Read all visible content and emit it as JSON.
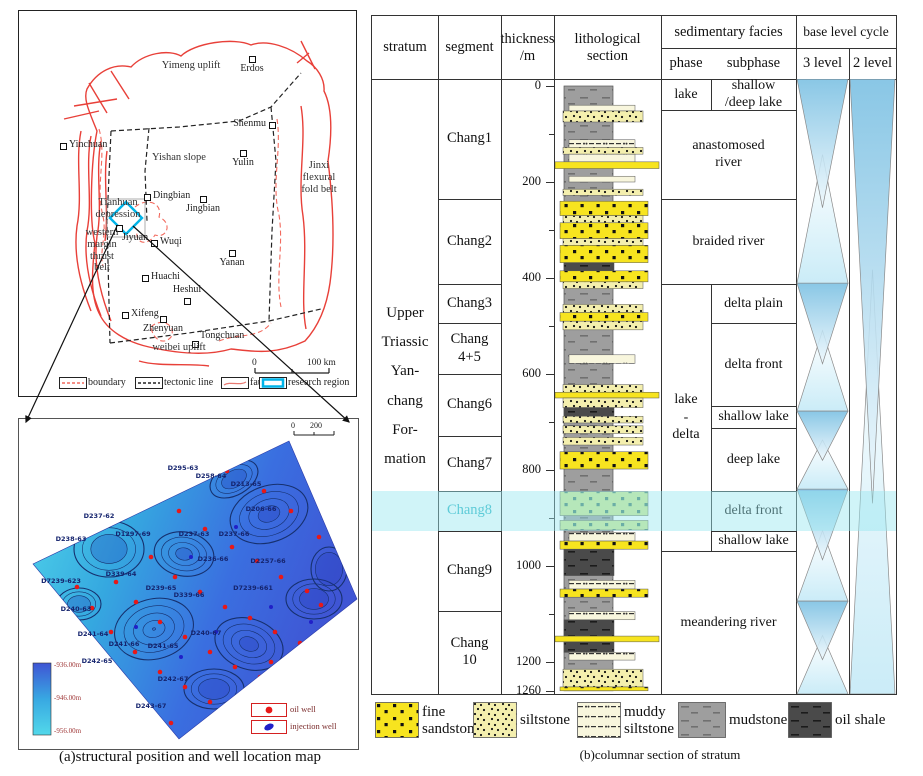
{
  "colors": {
    "map_red": "#e84039",
    "research_cyan": "#00b4e8",
    "oil_well_red": "#e81818",
    "injection_blue": "#2020c8",
    "highlight_band": "rgba(150,230,240,0.45)",
    "chang8_text": "#2fb4c4",
    "contour_navy": "#16306e"
  },
  "captions": {
    "a": "(a)structural position and well location map",
    "b": "(b)columnar section of stratum"
  },
  "map": {
    "cities": [
      {
        "name": "Yinchuan",
        "x": 44,
        "y": 135,
        "a": "r"
      },
      {
        "name": "Erdos",
        "x": 233,
        "y": 48,
        "a": "b"
      },
      {
        "name": "Shenmu",
        "x": 253,
        "y": 114,
        "a": "l"
      },
      {
        "name": "Yulin",
        "x": 224,
        "y": 142,
        "a": "b"
      },
      {
        "name": "Dingbian",
        "x": 128,
        "y": 186,
        "a": "r"
      },
      {
        "name": "Jingbian",
        "x": 184,
        "y": 188,
        "a": "b"
      },
      {
        "name": "Jiyuan",
        "x": 100,
        "y": 217,
        "a": "br"
      },
      {
        "name": "Wuqi",
        "x": 135,
        "y": 232,
        "a": "r"
      },
      {
        "name": "Yanan",
        "x": 213,
        "y": 242,
        "a": "b"
      },
      {
        "name": "Huachi",
        "x": 126,
        "y": 267,
        "a": "r"
      },
      {
        "name": "Heshui",
        "x": 168,
        "y": 290,
        "a": "t"
      },
      {
        "name": "Xifeng",
        "x": 106,
        "y": 304,
        "a": "r"
      },
      {
        "name": "Zhenyuan",
        "x": 144,
        "y": 308,
        "a": "b"
      },
      {
        "name": "Tongchuan",
        "x": 176,
        "y": 333,
        "a": "tr"
      }
    ],
    "regions": [
      {
        "lines": [
          "Yimeng uplift"
        ],
        "x": 172,
        "y": 55
      },
      {
        "lines": [
          "Yishan slope"
        ],
        "x": 160,
        "y": 147
      },
      {
        "lines": [
          "Jinxi",
          "flexural",
          "fold belt"
        ],
        "x": 300,
        "y": 155
      },
      {
        "lines": [
          "Tianhuan",
          "depression"
        ],
        "x": 99,
        "y": 192
      },
      {
        "lines": [
          "western",
          "margin",
          "thrust",
          "belt"
        ],
        "x": 83,
        "y": 222
      },
      {
        "lines": [
          "weibei uplift"
        ],
        "x": 160,
        "y": 337
      }
    ],
    "legend": [
      {
        "label": "boundary",
        "type": "rdash",
        "x": 40
      },
      {
        "label": "tectonic line",
        "type": "kdash",
        "x": 116
      },
      {
        "label": "fault",
        "type": "rline",
        "x": 202
      },
      {
        "label": "research region",
        "type": "crect",
        "x": 240
      }
    ],
    "scale": {
      "left": "0",
      "right": "100 km"
    }
  },
  "contour": {
    "scale": {
      "left": "0",
      "right": "200"
    },
    "colorbar_labels": [
      "-936.00m",
      "-946.00m",
      "-956.00m"
    ],
    "legend": [
      {
        "label": "oil well",
        "dot": "#e81818"
      },
      {
        "label": "injection well",
        "dot": "#2020c8"
      }
    ],
    "well_labels": [
      {
        "name": "D295-63",
        "x": 164,
        "y": 49
      },
      {
        "name": "D258-64",
        "x": 192,
        "y": 57
      },
      {
        "name": "D213-65",
        "x": 227,
        "y": 65
      },
      {
        "name": "D206-66",
        "x": 242,
        "y": 90
      },
      {
        "name": "D237-62",
        "x": 80,
        "y": 97
      },
      {
        "name": "D1297-69",
        "x": 114,
        "y": 115
      },
      {
        "name": "D237-63",
        "x": 175,
        "y": 115
      },
      {
        "name": "D237-66",
        "x": 215,
        "y": 115
      },
      {
        "name": "D238-63",
        "x": 52,
        "y": 120
      },
      {
        "name": "D236-66",
        "x": 194,
        "y": 140
      },
      {
        "name": "D2257-66",
        "x": 249,
        "y": 142
      },
      {
        "name": "D339-64",
        "x": 102,
        "y": 155
      },
      {
        "name": "D7239-623",
        "x": 42,
        "y": 162
      },
      {
        "name": "D239-65",
        "x": 142,
        "y": 169
      },
      {
        "name": "D339-66",
        "x": 170,
        "y": 176
      },
      {
        "name": "D7239-661",
        "x": 234,
        "y": 169
      },
      {
        "name": "D240-63",
        "x": 57,
        "y": 190
      },
      {
        "name": "D241-64",
        "x": 74,
        "y": 215
      },
      {
        "name": "D240-67",
        "x": 187,
        "y": 214
      },
      {
        "name": "D241-66",
        "x": 105,
        "y": 225
      },
      {
        "name": "D241-65",
        "x": 144,
        "y": 227
      },
      {
        "name": "D242-65",
        "x": 78,
        "y": 242
      },
      {
        "name": "D242-67",
        "x": 154,
        "y": 260
      },
      {
        "name": "D243-67",
        "x": 132,
        "y": 287
      }
    ],
    "oil_wells": [
      [
        208,
        52
      ],
      [
        245,
        72
      ],
      [
        272,
        92
      ],
      [
        300,
        118
      ],
      [
        160,
        92
      ],
      [
        186,
        110
      ],
      [
        213,
        128
      ],
      [
        238,
        142
      ],
      [
        262,
        158
      ],
      [
        288,
        172
      ],
      [
        132,
        138
      ],
      [
        156,
        158
      ],
      [
        181,
        173
      ],
      [
        206,
        188
      ],
      [
        231,
        199
      ],
      [
        256,
        213
      ],
      [
        281,
        224
      ],
      [
        97,
        163
      ],
      [
        117,
        183
      ],
      [
        141,
        203
      ],
      [
        166,
        218
      ],
      [
        191,
        233
      ],
      [
        216,
        248
      ],
      [
        241,
        258
      ],
      [
        73,
        189
      ],
      [
        92,
        213
      ],
      [
        116,
        233
      ],
      [
        141,
        253
      ],
      [
        166,
        268
      ],
      [
        191,
        283
      ],
      [
        216,
        293
      ],
      [
        58,
        168
      ],
      [
        252,
        243
      ],
      [
        302,
        186
      ],
      [
        310,
        206
      ],
      [
        80,
        247
      ],
      [
        103,
        260
      ],
      [
        128,
        292
      ],
      [
        152,
        304
      ],
      [
        176,
        316
      ]
    ],
    "injection_wells": [
      [
        217,
        108
      ],
      [
        172,
        138
      ],
      [
        117,
        208
      ],
      [
        197,
        213
      ],
      [
        252,
        188
      ],
      [
        162,
        238
      ],
      [
        227,
        273
      ],
      [
        292,
        203
      ]
    ]
  },
  "table": {
    "headers": {
      "stratum": "stratum",
      "segment": "segment",
      "thickness": [
        "thickness",
        "/m"
      ],
      "lithology": [
        "lithological",
        "section"
      ],
      "facies": "sedimentary facies",
      "phase": "phase",
      "subphase": "subphase",
      "cycle": "base level cycle",
      "l3": "3 level",
      "l2": "2 level"
    },
    "stratum_lines": [
      "Upper",
      "Triassic",
      "Yan-",
      "chang",
      "For-",
      "mation"
    ],
    "segments": [
      {
        "lines": [
          "Chang1"
        ],
        "f0": 0.0,
        "f1": 0.195
      },
      {
        "lines": [
          "Chang2"
        ],
        "f0": 0.195,
        "f1": 0.333
      },
      {
        "lines": [
          "Chang3"
        ],
        "f0": 0.333,
        "f1": 0.397
      },
      {
        "lines": [
          "Chang",
          "4+5"
        ],
        "f0": 0.397,
        "f1": 0.48
      },
      {
        "lines": [
          "Chang6"
        ],
        "f0": 0.48,
        "f1": 0.58
      },
      {
        "lines": [
          "Chang7"
        ],
        "f0": 0.58,
        "f1": 0.67
      },
      {
        "lines": [
          "Chang8"
        ],
        "f0": 0.67,
        "f1": 0.735,
        "highlight": true
      },
      {
        "lines": [
          "Chang9"
        ],
        "f0": 0.735,
        "f1": 0.865
      },
      {
        "lines": [
          "Chang",
          "10"
        ],
        "f0": 0.865,
        "f1": 1.0
      }
    ],
    "depth": {
      "max_m": 1260,
      "major_ticks": [
        {
          "m": 0,
          "label": "0"
        },
        {
          "m": 200,
          "label": "200"
        },
        {
          "m": 400,
          "label": "400"
        },
        {
          "m": 600,
          "label": "600"
        },
        {
          "m": 800,
          "label": "800"
        },
        {
          "m": 1000,
          "label": "1000"
        },
        {
          "m": 1200,
          "label": "1200"
        },
        {
          "m": 1260,
          "label": "1260"
        }
      ],
      "minor_ticks": [
        100,
        300,
        500,
        700,
        900,
        1100
      ]
    },
    "lithology_layers": [
      [
        40,
        52,
        "ms"
      ],
      [
        52,
        75,
        "st"
      ],
      [
        112,
        128,
        "ms"
      ],
      [
        128,
        142,
        "st"
      ],
      [
        142,
        158,
        "ms"
      ],
      [
        158,
        172,
        "ss"
      ],
      [
        188,
        200,
        "ms"
      ],
      [
        215,
        228,
        "st"
      ],
      [
        240,
        270,
        "fs"
      ],
      [
        270,
        285,
        "st"
      ],
      [
        285,
        318,
        "fs"
      ],
      [
        318,
        332,
        "st"
      ],
      [
        332,
        368,
        "fs"
      ],
      [
        368,
        385,
        "os"
      ],
      [
        385,
        408,
        "fs"
      ],
      [
        408,
        422,
        "st"
      ],
      [
        455,
        472,
        "st"
      ],
      [
        472,
        490,
        "fs"
      ],
      [
        490,
        508,
        "st"
      ],
      [
        560,
        578,
        "ms"
      ],
      [
        622,
        638,
        "st"
      ],
      [
        638,
        650,
        "ss"
      ],
      [
        650,
        670,
        "st"
      ],
      [
        670,
        688,
        "os"
      ],
      [
        688,
        702,
        "st"
      ],
      [
        708,
        724,
        "st"
      ],
      [
        732,
        748,
        "st"
      ],
      [
        762,
        798,
        "fs"
      ],
      [
        845,
        895,
        "g8"
      ],
      [
        905,
        925,
        "g8"
      ],
      [
        930,
        948,
        "ms"
      ],
      [
        948,
        965,
        "fs"
      ],
      [
        965,
        1020,
        "os"
      ],
      [
        1030,
        1048,
        "ms"
      ],
      [
        1048,
        1065,
        "fs"
      ],
      [
        1095,
        1112,
        "ms"
      ],
      [
        1112,
        1146,
        "os"
      ],
      [
        1146,
        1158,
        "ss"
      ],
      [
        1158,
        1180,
        "os"
      ],
      [
        1180,
        1196,
        "ms"
      ],
      [
        1215,
        1252,
        "st"
      ],
      [
        1252,
        1260,
        "fs"
      ]
    ],
    "facies": {
      "phases": [
        {
          "lines": [
            "lake"
          ],
          "f0": 0.0,
          "f1": 0.05,
          "span": false
        },
        {
          "lines": [
            "anastomosed",
            "river"
          ],
          "f0": 0.05,
          "f1": 0.195,
          "span": true
        },
        {
          "lines": [
            "braided river"
          ],
          "f0": 0.195,
          "f1": 0.333,
          "span": true
        },
        {
          "lines": [
            "lake",
            "-",
            "delta"
          ],
          "f0": 0.333,
          "f1": 0.768,
          "span": false
        },
        {
          "lines": [
            "meandering river"
          ],
          "f0": 0.768,
          "f1": 1.0,
          "span": true
        }
      ],
      "subphases": [
        {
          "lines": [
            "shallow",
            "/deep lake"
          ],
          "f0": 0.0,
          "f1": 0.05
        },
        {
          "lines": [
            "delta plain"
          ],
          "f0": 0.333,
          "f1": 0.397
        },
        {
          "lines": [
            "delta front"
          ],
          "f0": 0.397,
          "f1": 0.532
        },
        {
          "lines": [
            "shallow lake"
          ],
          "f0": 0.532,
          "f1": 0.567
        },
        {
          "lines": [
            "deep lake"
          ],
          "f0": 0.567,
          "f1": 0.67
        },
        {
          "lines": [
            "delta front"
          ],
          "f0": 0.67,
          "f1": 0.735
        },
        {
          "lines": [
            "shallow lake"
          ],
          "f0": 0.735,
          "f1": 0.768
        }
      ]
    },
    "cycles": {
      "three_level": [
        [
          0,
          0.332
        ],
        [
          0.332,
          0.54
        ],
        [
          0.54,
          0.667
        ],
        [
          0.667,
          0.849
        ],
        [
          0.849,
          1.0
        ]
      ],
      "two_level": [
        [
          0,
          1.0
        ]
      ]
    },
    "highlight_band": {
      "f0": 0.67,
      "f1": 0.735
    }
  },
  "legend_b": [
    {
      "lines": [
        "fine",
        "sandstone"
      ],
      "type": "fs",
      "x": 375,
      "w": 44
    },
    {
      "lines": [
        "siltstone"
      ],
      "type": "st",
      "x": 473,
      "w": 44
    },
    {
      "lines": [
        "muddy",
        "siltstone"
      ],
      "type": "ms",
      "x": 577,
      "w": 44
    },
    {
      "lines": [
        "mudstone"
      ],
      "type": "md",
      "x": 678,
      "w": 48
    },
    {
      "lines": [
        "oil shale"
      ],
      "type": "os",
      "x": 788,
      "w": 44
    }
  ]
}
